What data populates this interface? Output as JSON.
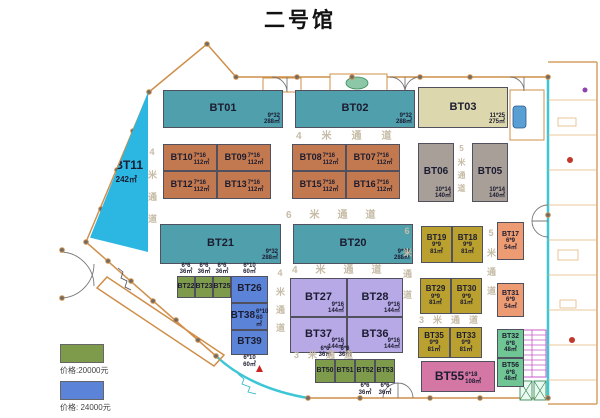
{
  "title": "二号馆",
  "palette": {
    "teal": "#4f9fad",
    "terracotta": "#c2794f",
    "beige": "#ddd7ad",
    "gray": "#a79f98",
    "mustard": "#b9a02f",
    "salmon": "#ec9b72",
    "olive": "#7e9b4c",
    "blue": "#5b84d8",
    "purple": "#b7a8e6",
    "pink": "#d577a5",
    "green": "#6fc593",
    "cyan": "#2cb7e3"
  },
  "booths": [
    {
      "id": "BT01",
      "color": "teal",
      "x": 163,
      "y": 90,
      "w": 120,
      "h": 38,
      "dims": "9*32",
      "area": "288㎡",
      "fs": 11,
      "ds": "br"
    },
    {
      "id": "BT02",
      "color": "teal",
      "x": 295,
      "y": 90,
      "w": 120,
      "h": 38,
      "dims": "9*32",
      "area": "288㎡",
      "fs": 11,
      "ds": "br"
    },
    {
      "id": "BT03",
      "color": "beige",
      "x": 418,
      "y": 87,
      "w": 90,
      "h": 41,
      "dims": "11*25",
      "area": "275㎡",
      "fs": 11,
      "ds": "br"
    },
    {
      "id": "BT11",
      "color": "cyan",
      "x": 90,
      "y": 92,
      "w": 58,
      "h": 160,
      "dims": "",
      "area": "242㎡",
      "fs": 12,
      "ds": "center",
      "shape": "tri"
    },
    {
      "id": "BT10",
      "color": "terracotta",
      "x": 163,
      "y": 144,
      "w": 54,
      "h": 27,
      "dims": "7*16",
      "area": "112㎡",
      "fs": 9,
      "ds": "inline"
    },
    {
      "id": "BT09",
      "color": "terracotta",
      "x": 217,
      "y": 144,
      "w": 54,
      "h": 27,
      "dims": "7*16",
      "area": "112㎡",
      "fs": 9,
      "ds": "inline"
    },
    {
      "id": "BT08",
      "color": "terracotta",
      "x": 292,
      "y": 144,
      "w": 54,
      "h": 27,
      "dims": "7*16",
      "area": "112㎡",
      "fs": 9,
      "ds": "inline"
    },
    {
      "id": "BT07",
      "color": "terracotta",
      "x": 346,
      "y": 144,
      "w": 54,
      "h": 27,
      "dims": "7*16",
      "area": "112㎡",
      "fs": 9,
      "ds": "inline"
    },
    {
      "id": "BT12",
      "color": "terracotta",
      "x": 163,
      "y": 171,
      "w": 54,
      "h": 28,
      "dims": "7*16",
      "area": "112㎡",
      "fs": 9,
      "ds": "inline"
    },
    {
      "id": "BT13",
      "color": "terracotta",
      "x": 217,
      "y": 171,
      "w": 54,
      "h": 28,
      "dims": "7*16",
      "area": "112㎡",
      "fs": 9,
      "ds": "inline"
    },
    {
      "id": "BT15",
      "color": "terracotta",
      "x": 292,
      "y": 171,
      "w": 54,
      "h": 28,
      "dims": "7*16",
      "area": "112㎡",
      "fs": 9,
      "ds": "inline"
    },
    {
      "id": "BT16",
      "color": "terracotta",
      "x": 346,
      "y": 171,
      "w": 54,
      "h": 28,
      "dims": "7*16",
      "area": "112㎡",
      "fs": 9,
      "ds": "inline"
    },
    {
      "id": "BT06",
      "color": "gray",
      "x": 418,
      "y": 143,
      "w": 36,
      "h": 59,
      "dims": "10*14",
      "area": "140㎡",
      "fs": 10,
      "ds": "br"
    },
    {
      "id": "BT05",
      "color": "gray",
      "x": 472,
      "y": 143,
      "w": 36,
      "h": 59,
      "dims": "10*14",
      "area": "140㎡",
      "fs": 10,
      "ds": "br"
    },
    {
      "id": "BT21",
      "color": "teal",
      "x": 160,
      "y": 224,
      "w": 121,
      "h": 40,
      "dims": "9*32",
      "area": "288㎡",
      "fs": 11,
      "ds": "br"
    },
    {
      "id": "BT20",
      "color": "teal",
      "x": 293,
      "y": 224,
      "w": 120,
      "h": 40,
      "dims": "9*32",
      "area": "288㎡",
      "fs": 11,
      "ds": "br"
    },
    {
      "id": "BT19",
      "color": "mustard",
      "x": 421,
      "y": 226,
      "w": 31,
      "h": 37,
      "dims": "9*9",
      "area": "81㎡",
      "fs": 8,
      "ds": "center"
    },
    {
      "id": "BT18",
      "color": "mustard",
      "x": 452,
      "y": 226,
      "w": 31,
      "h": 37,
      "dims": "9*9",
      "area": "81㎡",
      "fs": 8,
      "ds": "center"
    },
    {
      "id": "BT17",
      "color": "salmon",
      "x": 497,
      "y": 222,
      "w": 27,
      "h": 38,
      "dims": "6*9",
      "area": "54㎡",
      "fs": 7,
      "ds": "center"
    },
    {
      "id": "BT22",
      "color": "olive",
      "x": 177,
      "y": 276,
      "w": 18,
      "h": 22,
      "dims": "6*6",
      "area": "36㎡",
      "fs": 7,
      "ds": "above"
    },
    {
      "id": "BT23",
      "color": "olive",
      "x": 195,
      "y": 276,
      "w": 18,
      "h": 22,
      "dims": "6*6",
      "area": "36㎡",
      "fs": 7,
      "ds": "above"
    },
    {
      "id": "BT25",
      "color": "olive",
      "x": 213,
      "y": 276,
      "w": 18,
      "h": 22,
      "dims": "6*6",
      "area": "36㎡",
      "fs": 7,
      "ds": "above"
    },
    {
      "id": "BT26",
      "color": "blue",
      "x": 231,
      "y": 276,
      "w": 37,
      "h": 27,
      "dims": "6*10",
      "area": "60㎡",
      "fs": 10,
      "ds": "above"
    },
    {
      "id": "BT38",
      "color": "blue",
      "x": 231,
      "y": 303,
      "w": 37,
      "h": 27,
      "dims": "6*10",
      "area": "60㎡",
      "fs": 10,
      "ds": "inline"
    },
    {
      "id": "BT39",
      "color": "blue",
      "x": 231,
      "y": 330,
      "w": 37,
      "h": 25,
      "dims": "6*10",
      "area": "60㎡",
      "fs": 10,
      "ds": "below"
    },
    {
      "id": "BT27",
      "color": "purple",
      "x": 290,
      "y": 278,
      "w": 57,
      "h": 39,
      "dims": "9*16",
      "area": "144㎡",
      "fs": 11,
      "ds": "br"
    },
    {
      "id": "BT28",
      "color": "purple",
      "x": 347,
      "y": 278,
      "w": 56,
      "h": 39,
      "dims": "9*16",
      "area": "144㎡",
      "fs": 11,
      "ds": "br"
    },
    {
      "id": "BT37",
      "color": "purple",
      "x": 290,
      "y": 317,
      "w": 57,
      "h": 36,
      "dims": "9*16",
      "area": "144㎡",
      "fs": 11,
      "ds": "br"
    },
    {
      "id": "BT36",
      "color": "purple",
      "x": 347,
      "y": 317,
      "w": 56,
      "h": 36,
      "dims": "9*16",
      "area": "144㎡",
      "fs": 11,
      "ds": "br"
    },
    {
      "id": "BT29",
      "color": "mustard",
      "x": 420,
      "y": 278,
      "w": 31,
      "h": 36,
      "dims": "9*9",
      "area": "81㎡",
      "fs": 8,
      "ds": "center"
    },
    {
      "id": "BT30",
      "color": "mustard",
      "x": 451,
      "y": 278,
      "w": 31,
      "h": 36,
      "dims": "9*9",
      "area": "81㎡",
      "fs": 8,
      "ds": "center"
    },
    {
      "id": "BT31",
      "color": "salmon",
      "x": 497,
      "y": 283,
      "w": 27,
      "h": 34,
      "dims": "6*9",
      "area": "54㎡",
      "fs": 7,
      "ds": "center"
    },
    {
      "id": "BT35",
      "color": "mustard",
      "x": 418,
      "y": 327,
      "w": 32,
      "h": 31,
      "dims": "9*9",
      "area": "81㎡",
      "fs": 8,
      "ds": "center"
    },
    {
      "id": "BT33",
      "color": "mustard",
      "x": 450,
      "y": 327,
      "w": 32,
      "h": 31,
      "dims": "9*9",
      "area": "81㎡",
      "fs": 8,
      "ds": "center"
    },
    {
      "id": "BT32",
      "color": "green",
      "x": 497,
      "y": 329,
      "w": 27,
      "h": 29,
      "dims": "6*8",
      "area": "48㎡",
      "fs": 7,
      "ds": "center"
    },
    {
      "id": "BT50",
      "color": "olive",
      "x": 315,
      "y": 359,
      "w": 20,
      "h": 24,
      "dims": "6*6",
      "area": "36㎡",
      "fs": 7,
      "ds": "above"
    },
    {
      "id": "BT51",
      "color": "olive",
      "x": 335,
      "y": 359,
      "w": 20,
      "h": 24,
      "dims": "6*6",
      "area": "36㎡",
      "fs": 7,
      "ds": "above"
    },
    {
      "id": "BT52",
      "color": "olive",
      "x": 355,
      "y": 359,
      "w": 20,
      "h": 24,
      "dims": "6*6",
      "area": "36㎡",
      "fs": 7,
      "ds": "below"
    },
    {
      "id": "BT53",
      "color": "olive",
      "x": 375,
      "y": 359,
      "w": 20,
      "h": 24,
      "dims": "6*6",
      "area": "36㎡",
      "fs": 7,
      "ds": "below"
    },
    {
      "id": "BT55",
      "color": "pink",
      "x": 421,
      "y": 361,
      "w": 74,
      "h": 31,
      "dims": "6*18",
      "area": "108㎡",
      "fs": 12,
      "ds": "inline"
    },
    {
      "id": "BT56",
      "color": "green",
      "x": 497,
      "y": 358,
      "w": 27,
      "h": 29,
      "dims": "6*8",
      "area": "48㎡",
      "fs": 7,
      "ds": "center"
    }
  ],
  "passages": [
    {
      "text": "4米通道",
      "x": 296,
      "y": 127,
      "v": false,
      "ls": 20,
      "fs": 10
    },
    {
      "text": "6米通道",
      "x": 286,
      "y": 206,
      "v": false,
      "ls": 18,
      "fs": 10
    },
    {
      "text": "4米通道",
      "x": 292,
      "y": 261,
      "v": false,
      "ls": 18,
      "fs": 10
    },
    {
      "text": "3米通道",
      "x": 419,
      "y": 313,
      "v": false,
      "ls": 9,
      "fs": 9
    },
    {
      "text": "3米通道",
      "x": 294,
      "y": 348,
      "v": false,
      "ls": 9,
      "fs": 9
    },
    {
      "text": "4米通道",
      "x": 146,
      "y": 147,
      "v": true,
      "ls": 13,
      "fs": 9
    },
    {
      "text": "5米通道",
      "x": 456,
      "y": 144,
      "v": true,
      "ls": 5,
      "fs": 8
    },
    {
      "text": "6米通道",
      "x": 401,
      "y": 226,
      "v": true,
      "ls": 12,
      "fs": 9
    },
    {
      "text": "5米通道",
      "x": 485,
      "y": 228,
      "v": true,
      "ls": 10,
      "fs": 9
    },
    {
      "text": "4米通道",
      "x": 274,
      "y": 268,
      "v": true,
      "ls": 9,
      "fs": 9
    }
  ],
  "legend": {
    "items": [
      {
        "color": "#7e9b4c",
        "label": "价格:20000元"
      },
      {
        "color": "#5b84d8",
        "label": "价格: 24000元"
      }
    ]
  }
}
